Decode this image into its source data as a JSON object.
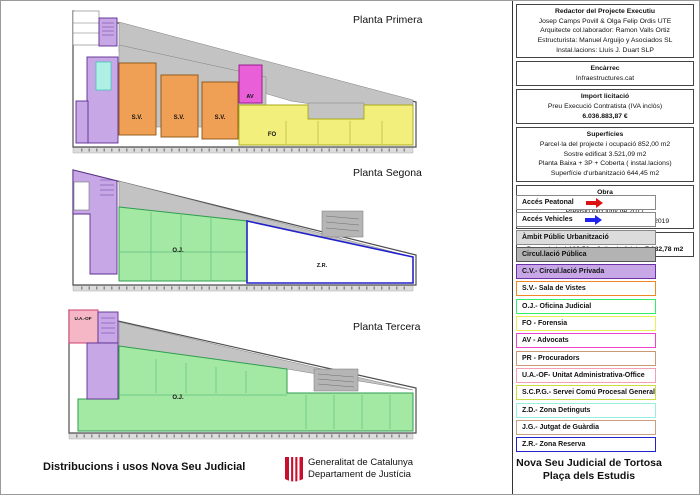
{
  "plans": [
    {
      "title": "Planta Primera",
      "labels": {
        "sv": "S.V.",
        "av": "AV",
        "fo": "FO"
      }
    },
    {
      "title": "Planta Segona",
      "labels": {
        "oj": "O.J.",
        "zr": "Z.R."
      }
    },
    {
      "title": "Planta Tercera",
      "labels": {
        "oj": "O.J.",
        "uaof": "U.A.-OF"
      }
    }
  ],
  "info_boxes": [
    {
      "title": "Redactor del Projecte Executiu",
      "lines": [
        "Josep Camps Povill & Olga Felip Ordis UTE",
        "Arquitecte col.laborador: Ramon Valls Ortiz",
        "Estructurista: Manuel Arguijo y Asociados SL",
        "Instal.lacions: Lluís J. Duart SLP"
      ]
    },
    {
      "title": "Encàrrec",
      "lines": [
        "Infraestructures.cat"
      ]
    },
    {
      "title": "Import licitació",
      "lines": [
        "Preu Execució Contratista (IVA inclòs)"
      ],
      "bold_line": "6.036.883,87 €"
    },
    {
      "title": "Superfícies",
      "lines": [
        "Parcel·la del projecte i ocupació 852,00 m2",
        "Sostre edificat 3.521,09 m2",
        "Planta Baixa + 3P + Coberta ( instal.lacions)",
        "Superfície d'urbanització  644,45 m2"
      ]
    },
    {
      "title": "Obra",
      "lines": [
        "Durada de les obres 20 mesos",
        "Previsió inici juny de 2017",
        "Previsió inici activitat segon trimestre 2019"
      ]
    },
    {
      "title": "Partit judicial de Tortosa",
      "line_prefix": "Passarà de 4.180,56 m2 d'us judicial  ",
      "line_bold": "a 7.132,78 m2"
    }
  ],
  "legend": {
    "items": [
      {
        "label": "Accés Peatonal",
        "bg": "#ffffff",
        "border": "#888888",
        "arrow": "#dd1111"
      },
      {
        "label": "Accés Vehicles",
        "bg": "#ffffff",
        "border": "#888888",
        "arrow": "#2222ee"
      },
      {
        "label": "Àmbit Públic Urbanització",
        "bg": "#dcdcdc",
        "border": "#888888"
      },
      {
        "label": "Circul.lació Pública",
        "bg": "#b3b3b3",
        "border": "#555555"
      },
      {
        "label": "C.V.- Circul.lació Privada",
        "bg": "#c7a7e6",
        "border": "#6a30a8"
      },
      {
        "label": "S.V.- Sala de Vistes",
        "bg": "#ffffff",
        "border": "#ee8822"
      },
      {
        "label": "O.J.- Oficina Judicial",
        "bg": "#ffffff",
        "border": "#33ee66"
      },
      {
        "label": "FO -  Forensia",
        "bg": "#ffffff",
        "border": "#eded55"
      },
      {
        "label": "AV -  Advocats",
        "bg": "#ffffff",
        "border": "#ee44cc"
      },
      {
        "label": "PR -  Procuradors",
        "bg": "#ffffff",
        "border": "#c89878"
      },
      {
        "label": "U.A.-OF- Unitat Administrativa-Office",
        "bg": "#ffffff",
        "border": "#f2a0b4"
      },
      {
        "label": "S.C.P.G.- Servei Comú Procesal General",
        "bg": "#ffffff",
        "border": "#ccdd44"
      },
      {
        "label": "Z.D.- Zona Detinguts",
        "bg": "#ffffff",
        "border": "#99eedd"
      },
      {
        "label": "J.G.- Jutgat de Guàrdia",
        "bg": "#ffffff",
        "border": "#c8a080"
      },
      {
        "label": "Z.R.- Zona Reserva",
        "bg": "#ffffff",
        "border": "#2222cc"
      }
    ]
  },
  "footer": {
    "left_title": "Distribucions i usos Nova Seu Judicial",
    "org_line1": "Generalitat de Catalunya",
    "org_line2": "Departament de Justícia"
  },
  "project_title": {
    "line1": "Nova Seu Judicial de Tortosa",
    "line2": "Plaça dels Estudis"
  },
  "colors": {
    "public_circulation": "#c3c3c3",
    "private_circulation": "#c7a7e6",
    "sala_de_vistes": "#f0a055",
    "oficina_judicial": "#a3e8a3",
    "forensia": "#f3ef7c",
    "advocats": "#e85fd8",
    "unitat_administrativa_office": "#f5b6c6",
    "zona_detinguts": "#b0f0e4",
    "zona_reserva_border": "#2222cc",
    "acces_peatonal_arrow": "#dd1111",
    "acces_vehicles_arrow": "#2222ee",
    "logo_red": "#c8102e"
  }
}
